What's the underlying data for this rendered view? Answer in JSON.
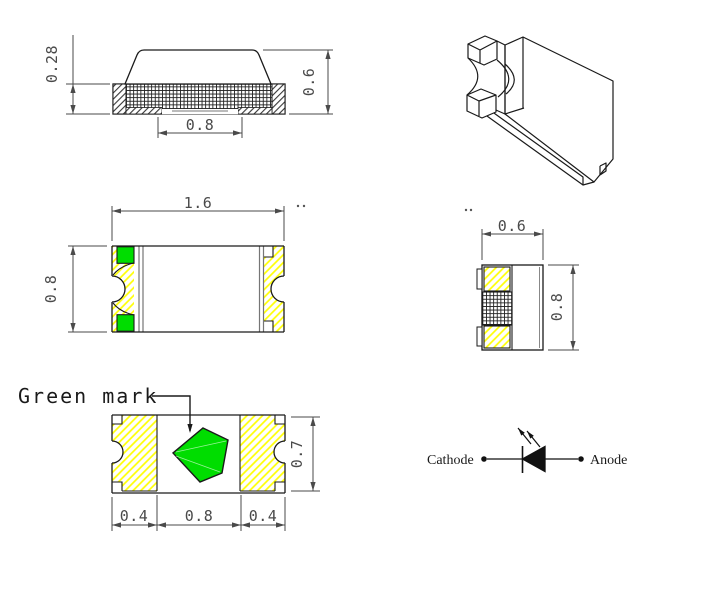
{
  "colors": {
    "green_mark": "#00dd00",
    "pad_hatch_yellow": "#ffff00",
    "outline": "#1a1a1a",
    "dimension": "#4a4a4a"
  },
  "icons": {
    "led_diode_symbol": "filled triangle with cathode bar",
    "light_emission_arrows": "two arrows pointing up-left",
    "green_mark_shape": "green pentagon polarity mark"
  },
  "side_view": {
    "dim_base_height": "0.28",
    "dim_total_height": "0.6",
    "dim_bottom_pad_width": "0.8"
  },
  "top_view": {
    "dim_length": "1.6",
    "dim_width": "0.8"
  },
  "end_view": {
    "dim_width": "0.6",
    "dim_height": "0.8"
  },
  "bottom_view": {
    "green_mark_label": "Green mark",
    "dim_pad_left": "0.4",
    "dim_center_pitch": "0.8",
    "dim_pad_right": "0.4",
    "dim_height": "0.7"
  },
  "circuit_symbol": {
    "cathode_label": "Cathode",
    "anode_label": "Anode"
  }
}
